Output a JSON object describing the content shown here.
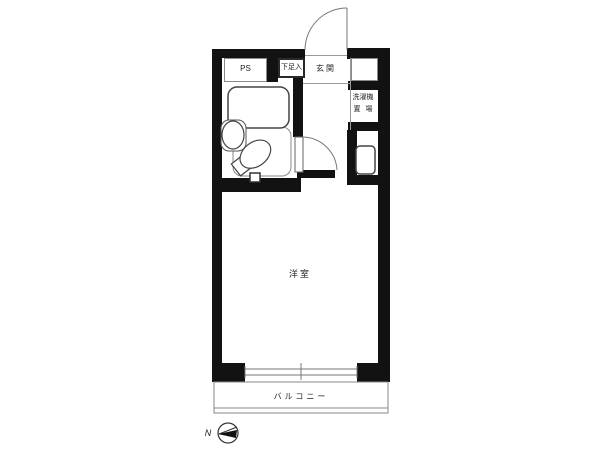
{
  "title": "studio apartment floor plan",
  "rooms": {
    "ps": "PS",
    "shoe_cabinet": "下足入",
    "entrance": "玄関",
    "laundry_line1": "洗濯機",
    "laundry_line2": "置場",
    "main_room": "洋室",
    "balcony": "バルコニー"
  },
  "fixtures": {
    "bathtub": "bathtub",
    "toilet": "toilet",
    "sink": "sink",
    "washer_pan": "washing-machine-pan",
    "window": "sliding-window",
    "entrance_door": "entrance-door",
    "room_door": "room-door"
  },
  "compass": {
    "north": "N",
    "direction": "left"
  },
  "colors": {
    "wall": "#121212",
    "thin_line": "#8a8a8a",
    "text": "#222222",
    "background": "#ffffff"
  }
}
